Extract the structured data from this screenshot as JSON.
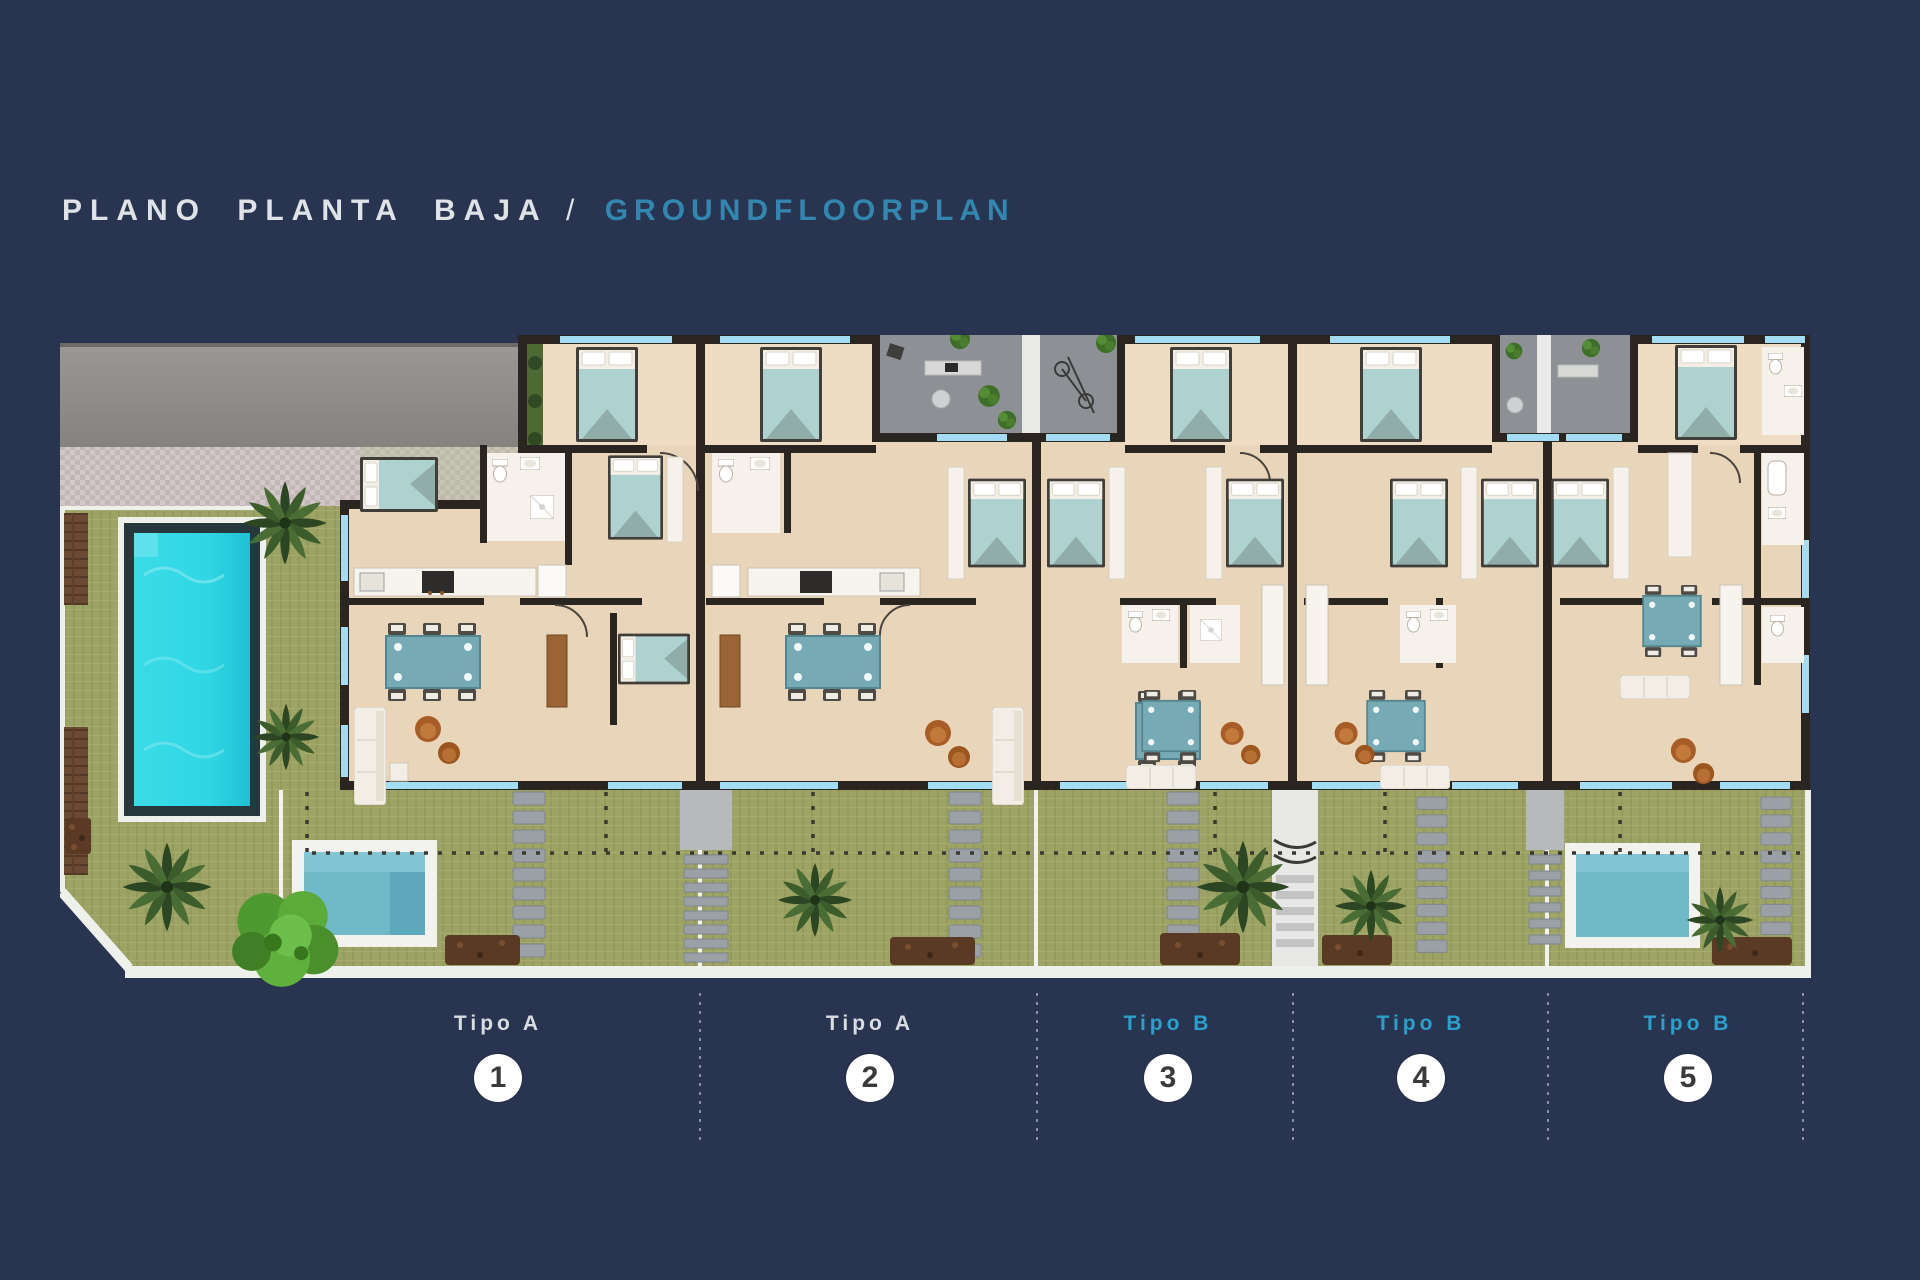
{
  "header": {
    "title_primary": "PLANO PLANTA BAJA",
    "separator": "/",
    "title_secondary": "GROUNDFLOORPLAN"
  },
  "units": [
    {
      "type": "Tipo A",
      "number": "1"
    },
    {
      "type": "Tipo A",
      "number": "2"
    },
    {
      "type": "Tipo B",
      "number": "3"
    },
    {
      "type": "Tipo B",
      "number": "4"
    },
    {
      "type": "Tipo B",
      "number": "5"
    }
  ],
  "colors": {
    "background": "#293450",
    "title_primary": "#dfe3e8",
    "title_secondary": "#3287b0",
    "tipo_a_label": "#d9dde2",
    "tipo_b_label": "#2aa0cc",
    "badge_bg": "#ffffff",
    "badge_text": "#3a3a3a",
    "pool_water": "#2fd6e4",
    "plunge_pool_water": "#6fb9c9",
    "garden_green": "#9da364",
    "building_floor": "#e9d5b9",
    "wall_dark": "#2a2520",
    "window_blue": "#a3ddf3",
    "patio_gray": "#8d9195",
    "driveway_gray": "#949090",
    "stairs_gray": "#9aa0a5",
    "mulch_brown": "#5a3a24",
    "palm_green": "#3f5a2d",
    "tree_green": "#5fae3c",
    "deck_wood": "#6b4a33",
    "plan_border": "#eef0ec"
  }
}
